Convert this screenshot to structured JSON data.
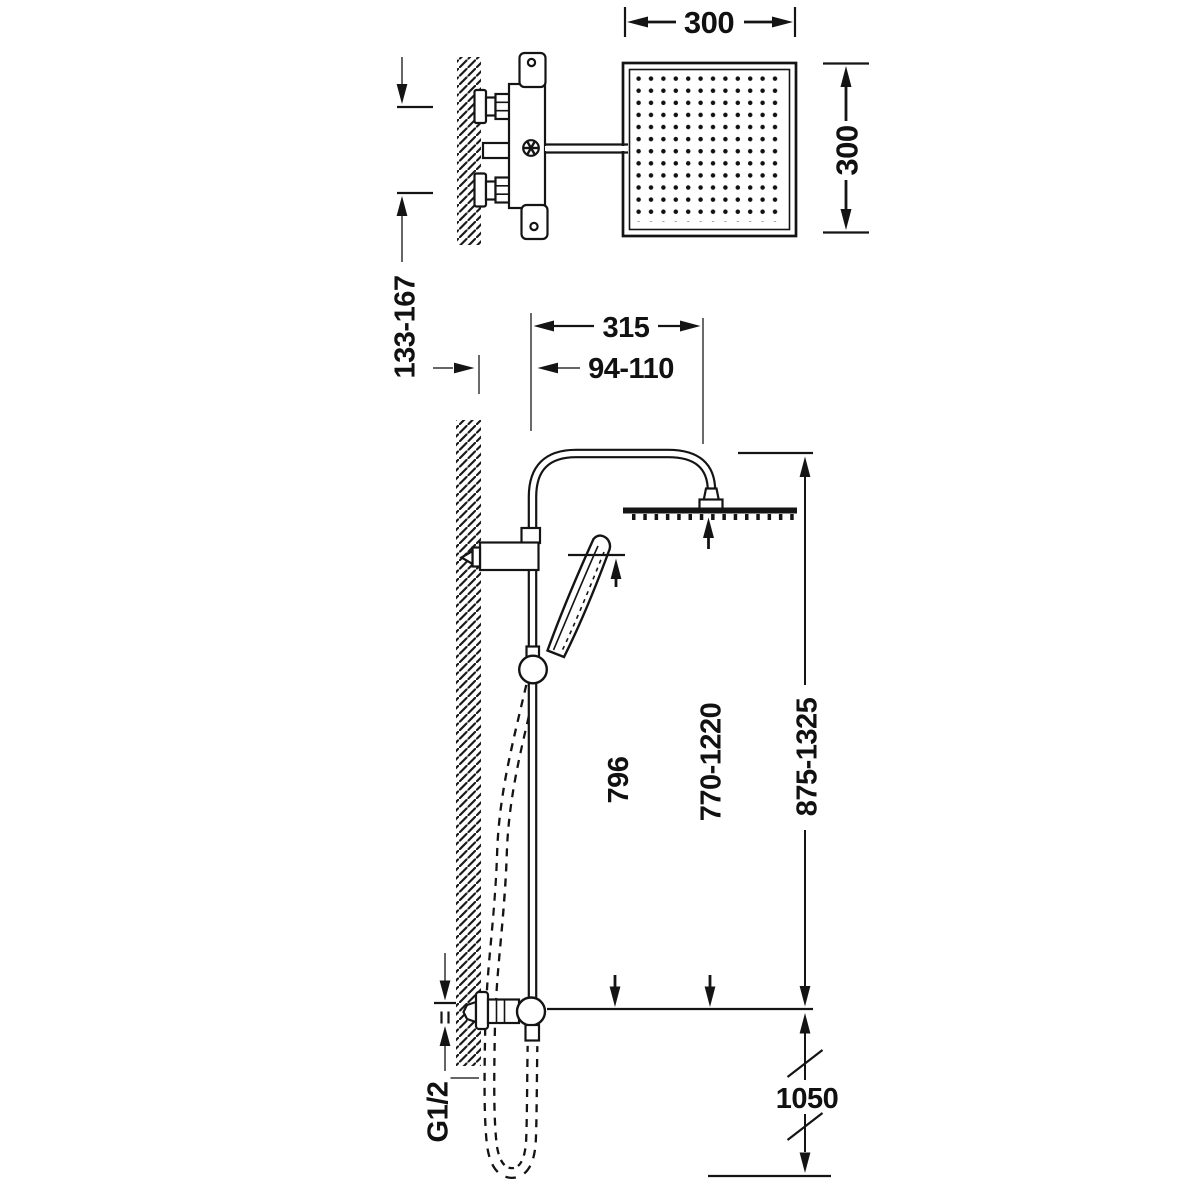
{
  "colors": {
    "background": "#ffffff",
    "ink": "#141414"
  },
  "diagram": {
    "type": "technical-dimension-drawing",
    "labels": {
      "head_width": "300",
      "head_depth": "300",
      "supply_spacing": "133-167",
      "arm_projection": "315",
      "wall_to_riser": "94-110",
      "handshower_bar_length": "796",
      "rainhead_height_range": "770-1220",
      "column_height_range": "875-1325",
      "supply_height": "1050",
      "connection_thread": "G1/2"
    }
  }
}
